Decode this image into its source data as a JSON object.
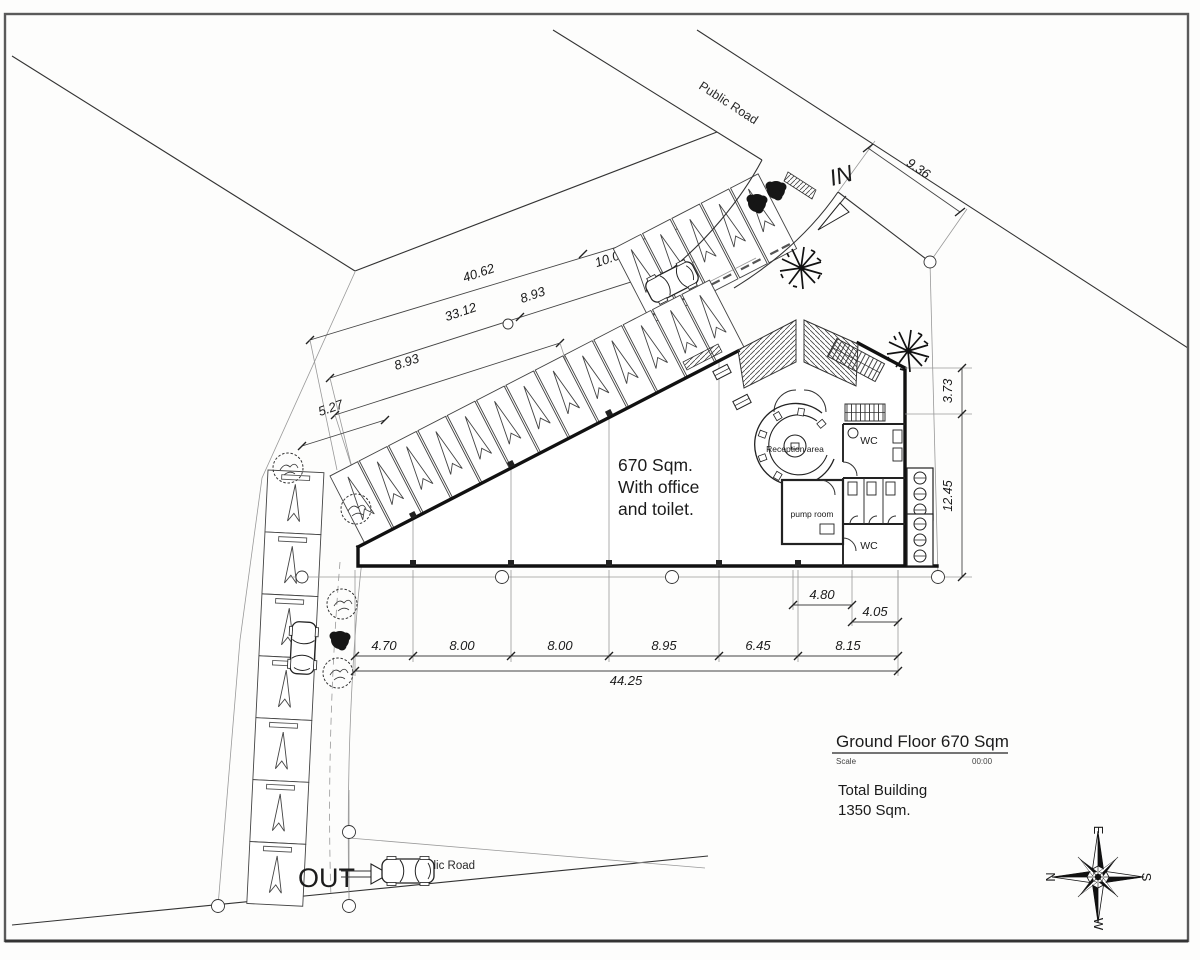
{
  "labels": {
    "public_road_top": "Public Road",
    "public_road_bottom": "Public Road",
    "entry_in": "IN",
    "exit_out": "OUT"
  },
  "building": {
    "area_note": {
      "l1": "670 Sqm.",
      "l2": "With office",
      "l3": "and toilet."
    },
    "reception": "Reception area",
    "pump_room": "pump room",
    "wc_upper": "WC",
    "wc_lower": "WC"
  },
  "dims": {
    "chain_top": {
      "a": "40.62",
      "b": "10.00",
      "c": "33.12",
      "d": "8.93",
      "e": "8.93",
      "f": "5.27"
    },
    "road_frontage": "9.36",
    "right_a": "3.73",
    "right_b": "12.45",
    "offset_a": "4.80",
    "offset_b": "4.05",
    "bottom": [
      "4.70",
      "8.00",
      "8.00",
      "8.95",
      "6.45",
      "8.15"
    ],
    "bottom_total": "44.25"
  },
  "title_block": {
    "title": "Ground Floor 670 Sqm",
    "scale_label": "Scale",
    "scale_value": "00:00",
    "total_1": "Total Building",
    "total_2": "1350 Sqm."
  },
  "compass": {
    "top": "E",
    "left": "N",
    "right": "S",
    "bottom": "W"
  }
}
